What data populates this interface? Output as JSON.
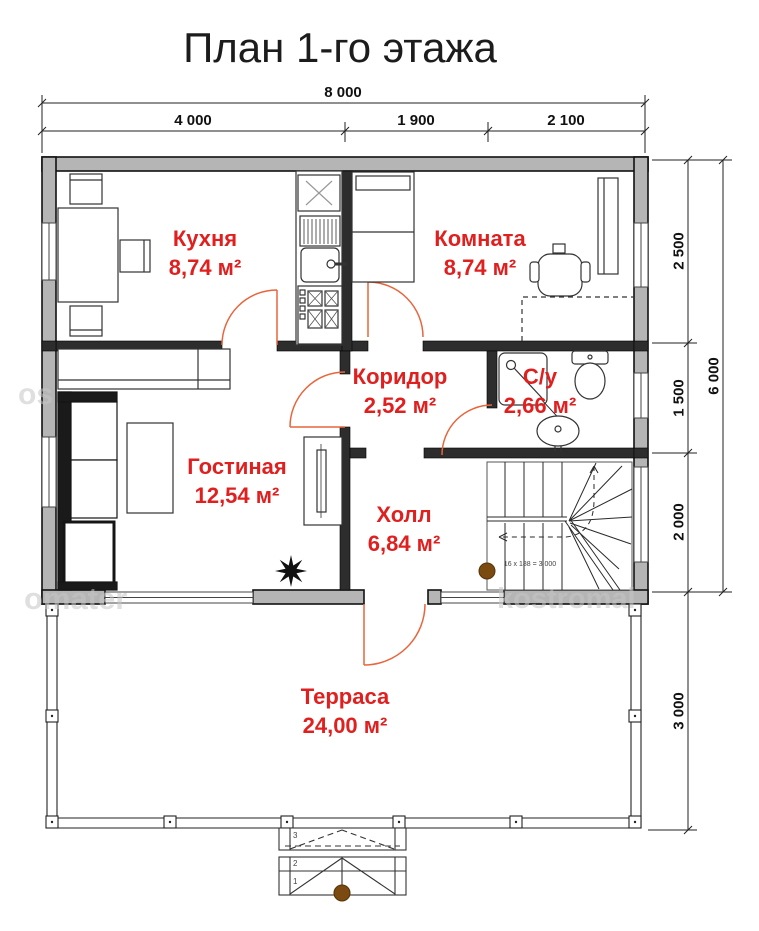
{
  "title": "План 1-го этажа",
  "dimensions": {
    "top_total": "8 000",
    "top_segments": [
      "4 000",
      "1 900",
      "2 100"
    ],
    "right_inner": [
      "2 500",
      "1 500",
      "2 000"
    ],
    "right_total": "6 000",
    "terrace_depth": "3 000"
  },
  "rooms": {
    "kitchen": {
      "name": "Кухня",
      "area": "8,74 м²"
    },
    "bedroom": {
      "name": "Комната",
      "area": "8,74 м²"
    },
    "corridor": {
      "name": "Коридор",
      "area": "2,52 м²"
    },
    "bathroom": {
      "name": "С/у",
      "area": "2,66 м²"
    },
    "living": {
      "name": "Гостиная",
      "area": "12,54 м²"
    },
    "hall": {
      "name": "Холл",
      "area": "6,84 м²"
    },
    "terrace": {
      "name": "Терраса",
      "area": "24,00 м²"
    }
  },
  "stairs": {
    "formula": "16 х 188 = 3 000"
  },
  "entrance_steps": {
    "numbers": [
      "3",
      "2",
      "1"
    ]
  },
  "watermarks": {
    "left_mid": "os",
    "bottom_left": "omater",
    "bottom_right": "kostromal"
  },
  "colors": {
    "wall_fill": "#b5b5b5",
    "interior_wall": "#2d2d2d",
    "label_red": "#e01f1f",
    "door_arc": "#e8653c",
    "column_brown": "#7b4a10"
  }
}
